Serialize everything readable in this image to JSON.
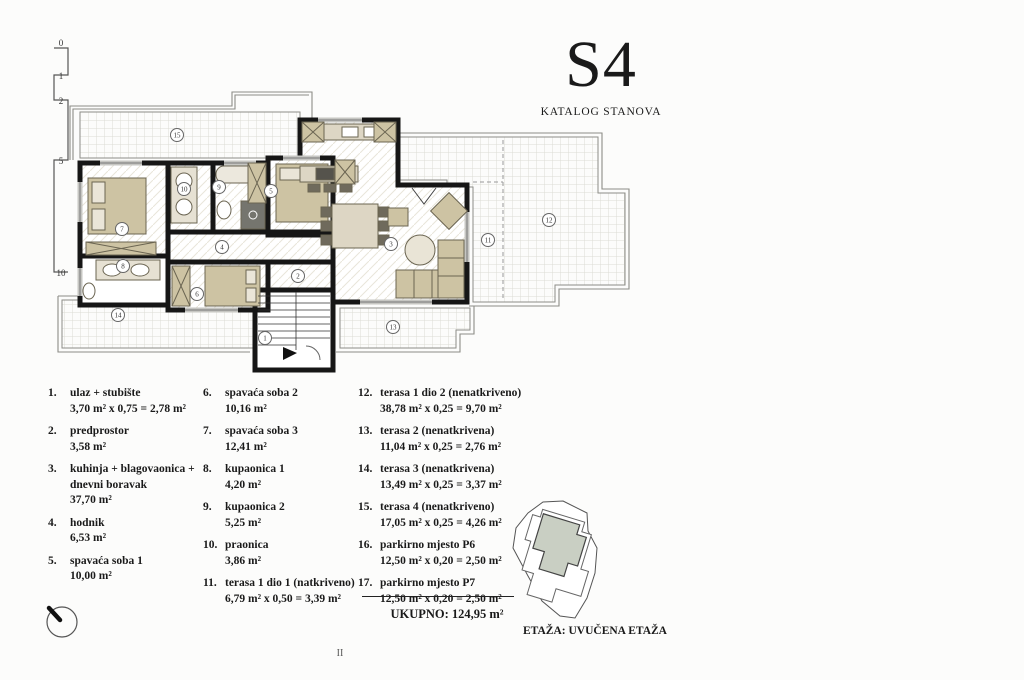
{
  "header": {
    "code": "S4",
    "subtitle": "KATALOG STANOVA"
  },
  "scale_bar": {
    "ticks": [
      "0",
      "1",
      "2",
      "5",
      "10"
    ]
  },
  "floor_plan": {
    "room_labels": [
      {
        "n": "1",
        "x": 265,
        "y": 338
      },
      {
        "n": "2",
        "x": 298,
        "y": 276
      },
      {
        "n": "3",
        "x": 391,
        "y": 244
      },
      {
        "n": "4",
        "x": 222,
        "y": 247
      },
      {
        "n": "5",
        "x": 271,
        "y": 191
      },
      {
        "n": "6",
        "x": 197,
        "y": 294
      },
      {
        "n": "7",
        "x": 122,
        "y": 229
      },
      {
        "n": "8",
        "x": 123,
        "y": 266
      },
      {
        "n": "9",
        "x": 219,
        "y": 187
      },
      {
        "n": "10",
        "x": 184,
        "y": 189
      },
      {
        "n": "11",
        "x": 488,
        "y": 240
      },
      {
        "n": "12",
        "x": 549,
        "y": 220
      },
      {
        "n": "13",
        "x": 393,
        "y": 327
      },
      {
        "n": "14",
        "x": 118,
        "y": 315
      },
      {
        "n": "15",
        "x": 177,
        "y": 135
      }
    ]
  },
  "legend": {
    "columns": [
      [
        {
          "num": "1.",
          "name": "ulaz + stubište",
          "area": "3,70 m² x 0,75 = 2,78 m²"
        },
        {
          "num": "2.",
          "name": "predprostor",
          "area": "3,58 m²"
        },
        {
          "num": "3.",
          "name": "kuhinja + blagovaonica + dnevni boravak",
          "area": "37,70 m²"
        },
        {
          "num": "4.",
          "name": "hodnik",
          "area": "6,53 m²"
        },
        {
          "num": "5.",
          "name": "spavaća soba 1",
          "area": "10,00 m²"
        }
      ],
      [
        {
          "num": "6.",
          "name": "spavaća soba 2",
          "area": "10,16 m²"
        },
        {
          "num": "7.",
          "name": "spavaća soba 3",
          "area": "12,41 m²"
        },
        {
          "num": "8.",
          "name": "kupaonica 1",
          "area": "4,20 m²"
        },
        {
          "num": "9.",
          "name": "kupaonica 2",
          "area": "5,25 m²"
        },
        {
          "num": "10.",
          "name": "praonica",
          "area": "3,86 m²"
        },
        {
          "num": "11.",
          "name": "terasa 1 dio 1 (natkriveno)",
          "area": "6,79 m² x 0,50 = 3,39 m²"
        }
      ],
      [
        {
          "num": "12.",
          "name": "terasa 1 dio 2 (nenatkriveno)",
          "area": "38,78 m² x 0,25 = 9,70 m²"
        },
        {
          "num": "13.",
          "name": "terasa 2 (nenatkrivena)",
          "area": "11,04 m² x 0,25 = 2,76 m²"
        },
        {
          "num": "14.",
          "name": "terasa 3 (nenatkrivena)",
          "area": "13,49 m² x 0,25 = 3,37 m²"
        },
        {
          "num": "15.",
          "name": "terasa 4 (nenatkriveno)",
          "area": "17,05 m² x 0,25 = 4,26 m²"
        },
        {
          "num": "16.",
          "name": "parkirno mjesto P6",
          "area": "12,50 m² x 0,20 = 2,50 m²"
        },
        {
          "num": "17.",
          "name": "parkirno mjesto P7",
          "area": "12,50 m² x 0,20 = 2,50 m²"
        }
      ]
    ]
  },
  "total": {
    "label": "UKUPNO:",
    "value": "124,95 m²"
  },
  "site_plan": {
    "caption": "ETAŽA: UVUČENA ETAŽA"
  },
  "page_number": "II",
  "colors": {
    "wall": "#161616",
    "furniture": "#cdc3a3",
    "terrace_line": "#8d8d87"
  }
}
